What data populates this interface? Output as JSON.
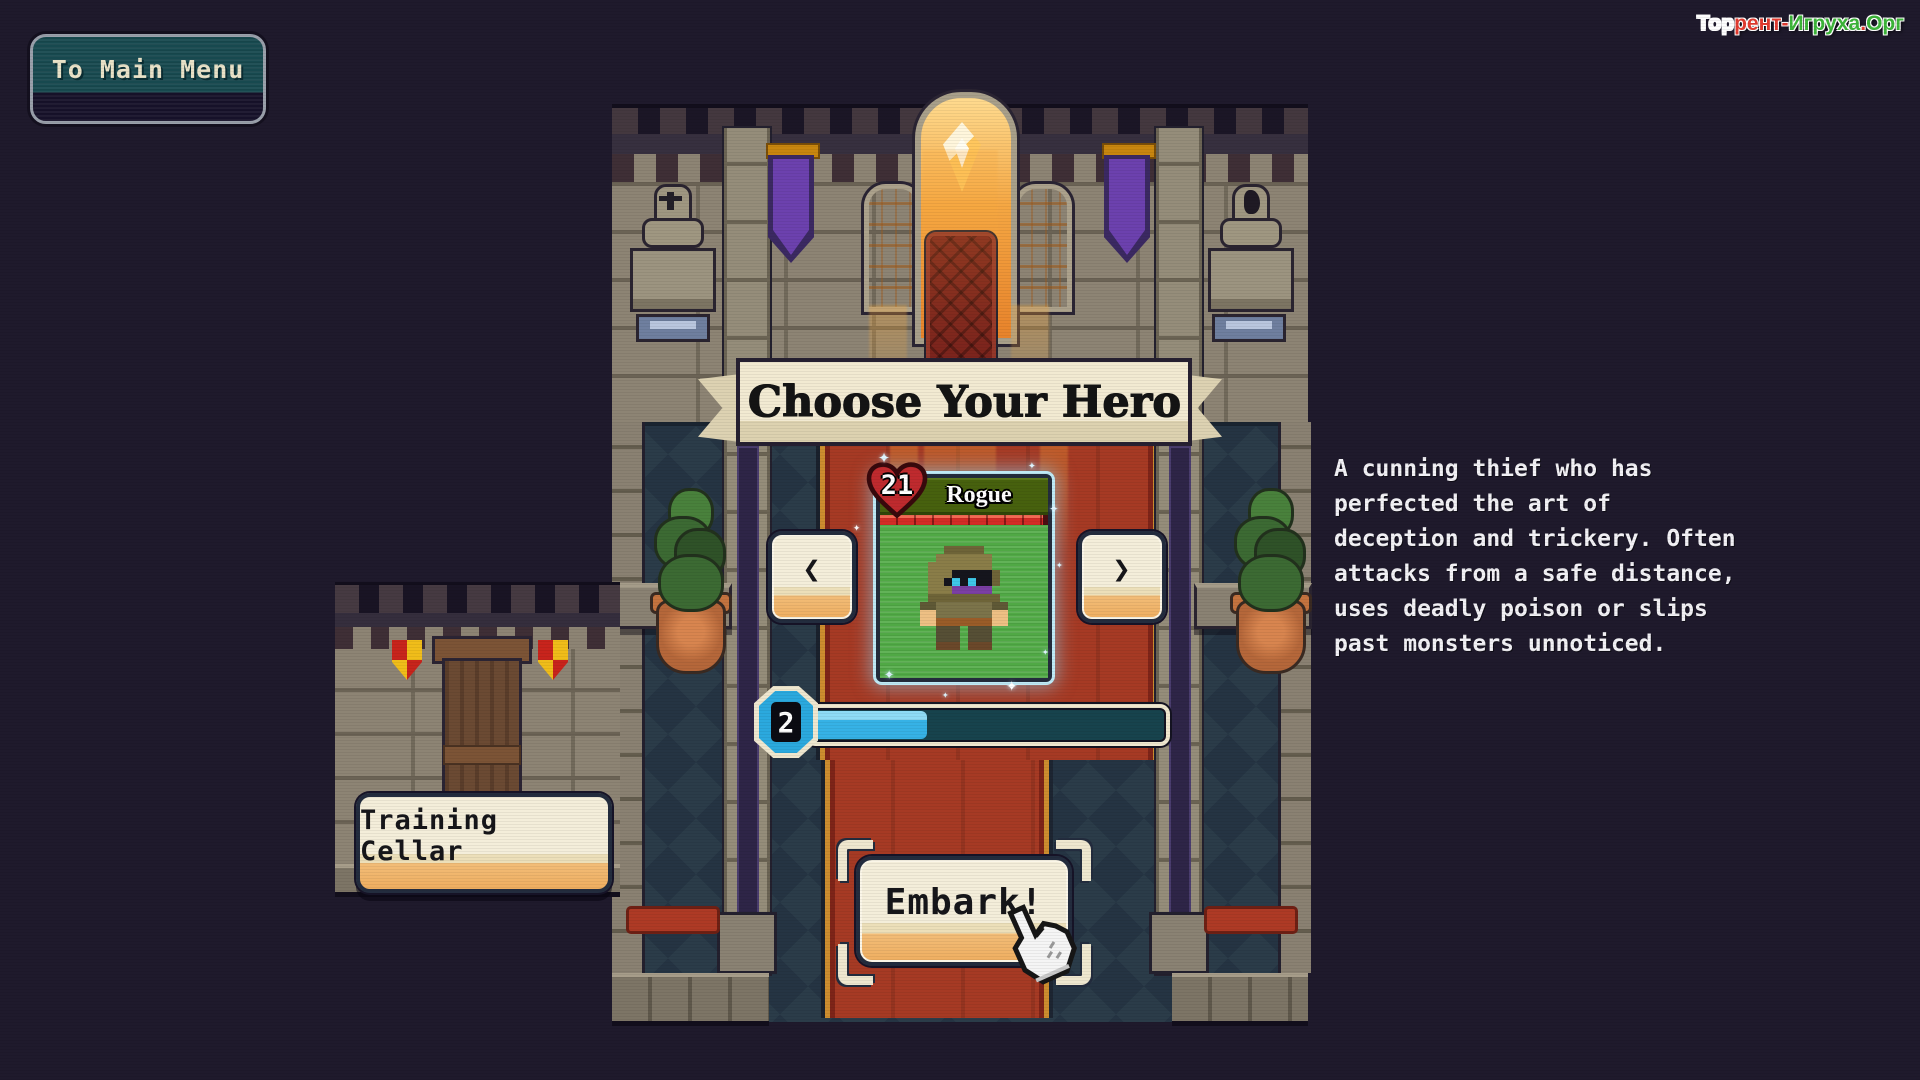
{
  "menu": {
    "to_main_menu": "To Main Menu"
  },
  "watermark": {
    "segments": [
      {
        "text": "Тор",
        "color": "#fdfdfd"
      },
      {
        "text": "рент-",
        "color": "#e23b30"
      },
      {
        "text": "Игруха",
        "color": "#3db53a"
      },
      {
        "text": ".",
        "color": "#e23b30"
      },
      {
        "text": "Орг",
        "color": "#3db53a"
      }
    ]
  },
  "banner": {
    "title": "Choose Your Hero"
  },
  "hero": {
    "name": "Rogue",
    "health": "21",
    "description_lines": [
      "A cunning thief who has",
      "perfected the art of",
      "deception and trickery. Often",
      "attacks from a safe distance,",
      "uses deadly poison or slips",
      "past monsters unnoticed."
    ]
  },
  "carousel": {
    "prev": "❮",
    "next": "❯"
  },
  "level": {
    "value": "2",
    "progress_percent": 32
  },
  "actions": {
    "embark": "Embark!",
    "training_cellar": "Training Cellar"
  },
  "decor": {
    "sparkle": "✦"
  },
  "colors": {
    "accent_blue": "#36b2e6",
    "card_green": "#50a945",
    "health_red": "#d42c26",
    "ui_cream": "#f2ecd6",
    "carpet_red": "#a63a24",
    "watermark_red": "#e23b30",
    "watermark_green": "#3db53a"
  }
}
